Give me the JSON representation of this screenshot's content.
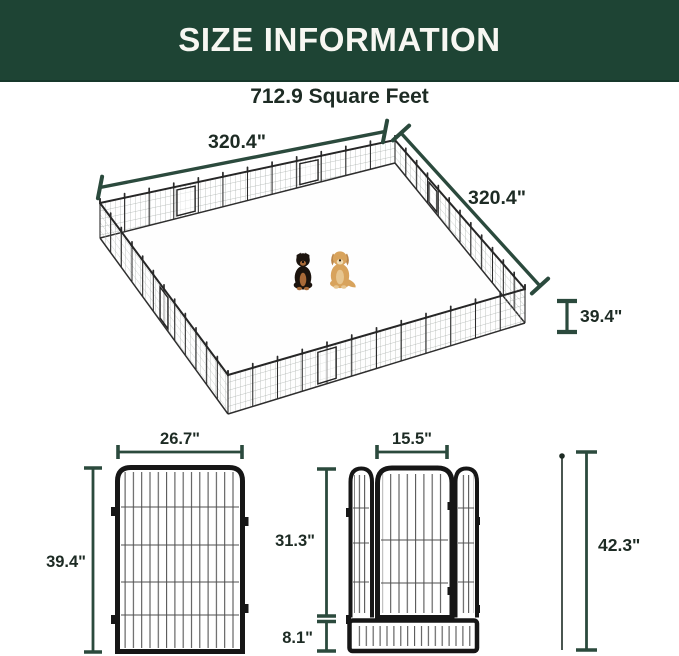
{
  "header": {
    "title": "SIZE INFORMATION"
  },
  "area": {
    "label": "712.9 Square Feet"
  },
  "pen_diagram": {
    "dim_left_side": "320.4\"",
    "dim_right_side": "320.4\"",
    "dim_height": "39.4\"",
    "dogs": [
      "black-and-tan-dog",
      "golden-dog"
    ]
  },
  "panel_diagram": {
    "dim_width": "26.7\"",
    "dim_height": "39.4\""
  },
  "door_panel_diagram": {
    "dim_door_width": "15.5\"",
    "dim_door_height": "31.3\"",
    "dim_bottom_height": "8.1\"",
    "dim_total_height": "42.3\""
  },
  "colors": {
    "header-bg": "#1e4434",
    "header-text": "#f7f7f2",
    "ink": "#1d2b24",
    "dim": "#2b4a3d",
    "frame": "#161616",
    "wire": "#4f4f4f",
    "mesh": "#a9afac",
    "dog-black": "#1c140e",
    "dog-tan": "#a96a38",
    "dog-gold": "#d8a35c",
    "dog-gold-light": "#e7c690"
  }
}
